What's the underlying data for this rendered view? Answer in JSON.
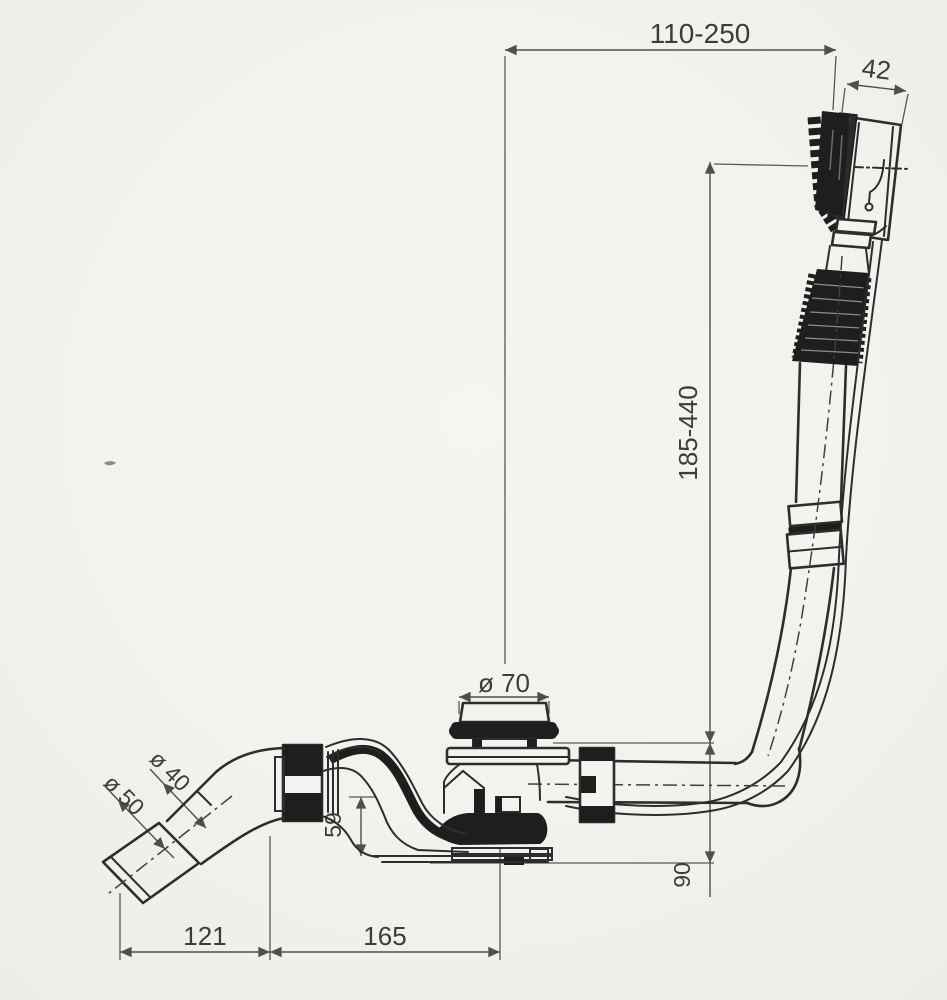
{
  "drawing": {
    "type": "technical-drawing",
    "subject": "bath-waste-overflow-assembly",
    "dimensions": {
      "top_span": "110-250",
      "overflow_width": "42",
      "overflow_drop": "185-440",
      "plug_diameter": "ø 70",
      "outlet_pipe_diameter": "ø 40",
      "outlet_sleeve_diameter": "ø 50",
      "trap_depth": "59",
      "base_drop": "90",
      "outlet_offset": "121",
      "trap_length": "165"
    },
    "colors": {
      "ink": "#2d2d2d",
      "dim_line": "#4f4f4f",
      "dark_fill": "#1e1e1e",
      "text": "#3c3c3c",
      "paper": "#f2f1ed"
    }
  }
}
